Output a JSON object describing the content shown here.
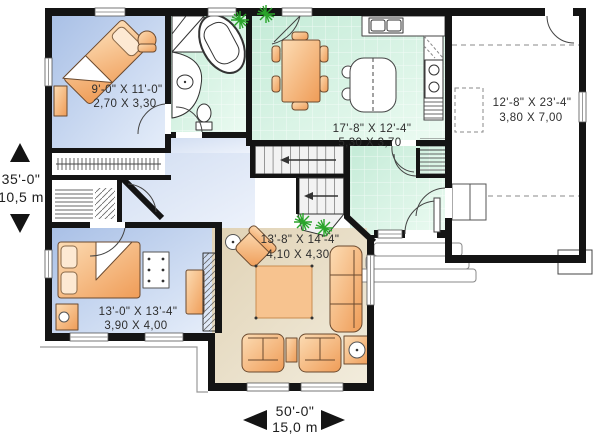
{
  "rooms": {
    "bedroom_upper": {
      "imperial": "9'-0\" X 11'-0\"",
      "metric": "2,70 X 3,30"
    },
    "kitchen_dining": {
      "imperial": "17'-8\" X 12'-4\"",
      "metric": "5,30 X 3,70"
    },
    "garage": {
      "imperial": "12'-8\" X 23'-4\"",
      "metric": "3,80 X 7,00"
    },
    "living_room": {
      "imperial": "13'-8\" X 14'-4\"",
      "metric": "4,10 X 4,30"
    },
    "master_bedroom": {
      "imperial": "13'-0\" X 13'-4\"",
      "metric": "3,90 X 4,00"
    }
  },
  "overall_dimensions": {
    "depth": {
      "imperial": "35'-0\"",
      "metric": "10,5 m"
    },
    "width": {
      "imperial": "50'-0\"",
      "metric": "15,0 m"
    }
  },
  "colors": {
    "wall": "#141414",
    "bedroom_floor": "#b9cce9",
    "tile_floor": "#d2efe0",
    "wood_floor": "#e8ddc5",
    "hall_floor": "#dfe8f6",
    "furniture": "#f5b87e",
    "plant": "#2aa42a",
    "dimension_text": "#222222"
  }
}
